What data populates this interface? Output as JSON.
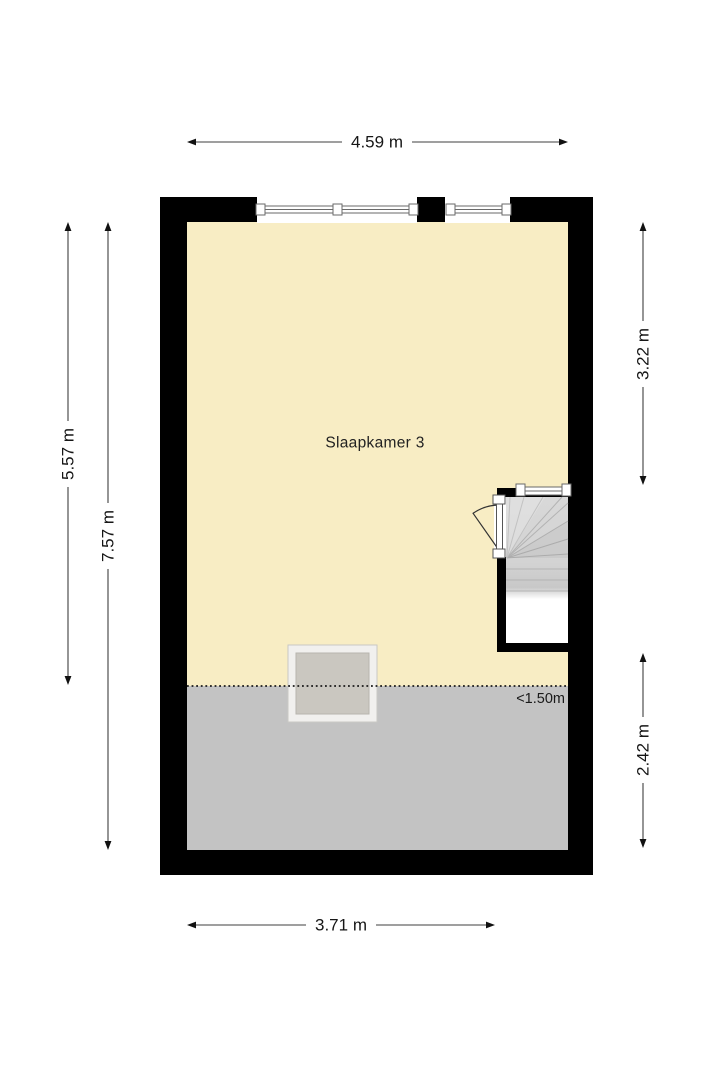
{
  "floorplan": {
    "room_label": "Slaapkamer 3",
    "low_headroom_label": "<1.50m",
    "dimensions": {
      "top_width": "4.59 m",
      "bottom_width": "3.71 m",
      "left_outer_height": "5.57 m",
      "left_inner_height": "7.57 m",
      "right_upper_height": "3.22 m",
      "right_lower_height": "2.42 m"
    },
    "colors": {
      "wall": "#000000",
      "room_fill": "#f8edc4",
      "low_headroom_fill": "#c3c3c3",
      "stair_fill": "#d6d6d6",
      "skylight_frame": "#f1f0ee",
      "skylight_glass": "#cac7c0",
      "dimension_line": "#3f3f3f",
      "background": "#ffffff"
    },
    "icons": {
      "windows": "window-icon",
      "door": "door-swing-icon",
      "stairs": "stairs-icon",
      "skylight": "skylight-icon"
    }
  }
}
